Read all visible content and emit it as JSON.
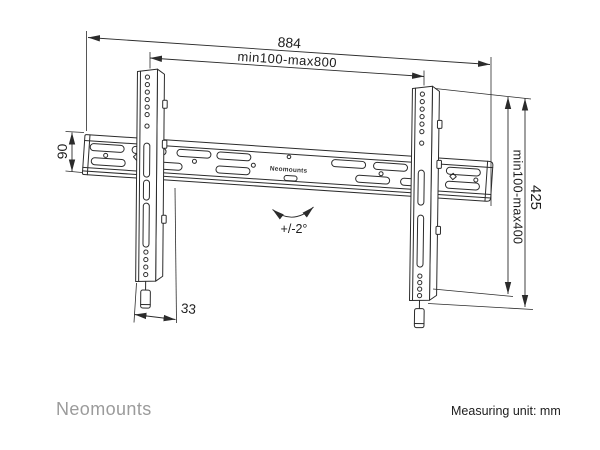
{
  "diagram": {
    "rail_brand": "Neomounts",
    "dimensions": {
      "total_width": "884",
      "mount_width_range": "min100-max800",
      "rail_height": "90",
      "mount_height_range": "min100-max400",
      "bracket_height": "425",
      "bracket_depth": "33",
      "tilt_range": "+/-2°"
    }
  },
  "footer": {
    "brand": "Neomounts",
    "measuring_unit_label": "Measuring unit: mm"
  },
  "colors": {
    "line": "#2b2b2b",
    "brand_gray": "#9b9b9b",
    "text": "#1d1d1d",
    "background": "#ffffff"
  }
}
